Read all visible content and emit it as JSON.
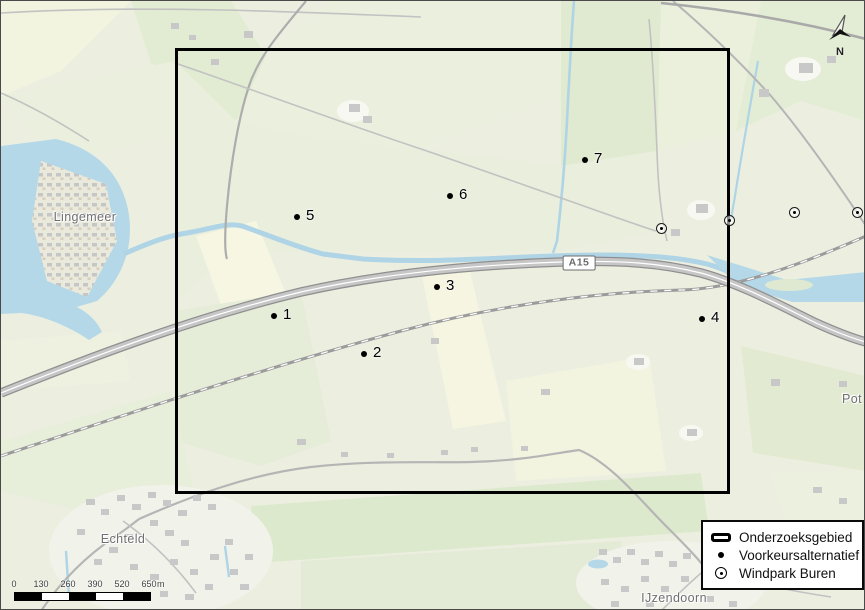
{
  "map": {
    "study_area": {
      "label": "Onderzoeksgebied",
      "x": 174,
      "y": 47,
      "width": 555,
      "height": 446
    },
    "place_labels": [
      {
        "name": "Lingemeer",
        "x": 84,
        "y": 216
      },
      {
        "name": "Echteld",
        "x": 122,
        "y": 538
      },
      {
        "name": "IJzendoorn",
        "x": 673,
        "y": 597
      },
      {
        "name": "Pot",
        "x": 851,
        "y": 398
      }
    ],
    "road_shield": {
      "label": "A15",
      "x": 578,
      "y": 262
    },
    "preferred_points": [
      {
        "label": "1",
        "x": 273,
        "y": 315
      },
      {
        "label": "2",
        "x": 363,
        "y": 353
      },
      {
        "label": "3",
        "x": 436,
        "y": 286
      },
      {
        "label": "4",
        "x": 701,
        "y": 318
      },
      {
        "label": "5",
        "x": 296,
        "y": 216
      },
      {
        "label": "6",
        "x": 449,
        "y": 195
      },
      {
        "label": "7",
        "x": 584,
        "y": 159
      }
    ],
    "windpark_points": [
      {
        "x": 660,
        "y": 227
      },
      {
        "x": 728,
        "y": 219
      },
      {
        "x": 793,
        "y": 211
      },
      {
        "x": 856,
        "y": 211
      }
    ]
  },
  "legend": {
    "items": [
      {
        "symbol": "study-area",
        "label": "Onderzoeksgebied"
      },
      {
        "symbol": "dot",
        "label": "Voorkeursalternatief"
      },
      {
        "symbol": "circled-dot",
        "label": "Windpark Buren"
      }
    ]
  },
  "scale_bar": {
    "ticks": [
      "0",
      "130",
      "260",
      "390",
      "520",
      "650"
    ],
    "unit": "m"
  },
  "north_arrow": {
    "label": "N"
  },
  "colors": {
    "study_area_outline": "#000000",
    "water": "#b5d8e8",
    "field_green": "#e3ecd5",
    "field_cream": "#f6f6e2",
    "highway_fill": "#c6c6c6",
    "building_gray": "#c8c8c8",
    "place_label_gray": "#6f6f6f"
  }
}
